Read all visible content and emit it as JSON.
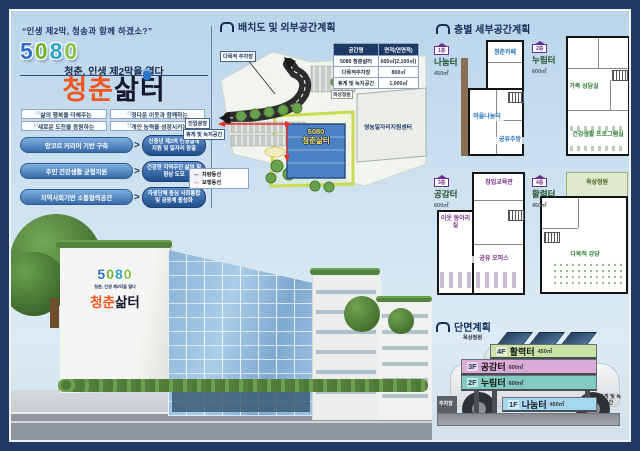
{
  "header": {
    "quote": "“인생 제2막, 청송과 함께 하겠소?”",
    "logo_letters": [
      "5",
      "0",
      "8",
      "0"
    ],
    "subtitle": "청춘, 인생 제2막을 열다",
    "title_orange": "청춘",
    "title_dark": "삶터",
    "value_boxes": [
      "삶의 행복을 더해주는",
      "정다운 이웃과 함께하는",
      "새로운 도전을 응원하는",
      "개인 능력을 성장시키는"
    ],
    "strategies": [
      {
        "goal": "앙코르 커리어 기반 구축",
        "outcome": "신중년 제2의 인생설계 지원 및 일자리 창출"
      },
      {
        "goal": "주민 건강생활 균형지원",
        "outcome": "건강한 지역주민 삶의 질 향상 도모"
      },
      {
        "goal": "지역사회기반 소통협력공간",
        "outcome": "자생단체 중심 사회통합 및 공동체 활성화"
      }
    ]
  },
  "site_plan": {
    "title": "배치도 및 외부공간계획",
    "table": {
      "headers": [
        "공간명",
        "면적(연면적)"
      ],
      "rows": [
        [
          "5080 청춘삶터",
          "600㎡(2,100㎡)"
        ],
        [
          "다목적주차장",
          "800㎡"
        ],
        [
          "휴게 및 녹지공간",
          "1,000㎡"
        ]
      ]
    },
    "labels": {
      "parking": "다목적 주차장",
      "plaza": "진입광장",
      "green": "휴게 및 녹지공간",
      "support_center": "영농일자리지원센터",
      "garden": "목성정원",
      "building_line1": "5080",
      "building_line2": "청춘삶터"
    },
    "legend": [
      {
        "label": "차량동선",
        "color": "#1a1a1a"
      },
      {
        "label": "보행동선",
        "color": "#e03131"
      }
    ]
  },
  "floor_plans": {
    "title": "층별 세부공간계획",
    "plans": [
      {
        "floor": "1층",
        "name": "나눔터",
        "area": "450㎡",
        "rooms": [
          "청춘카페",
          "마을나눔터",
          "공유주방"
        ]
      },
      {
        "floor": "2층",
        "name": "누림터",
        "area": "600㎡",
        "rooms": [
          "가족 상담실",
          "건강생활 프로그램실"
        ]
      },
      {
        "floor": "3층",
        "name": "공감터",
        "area": "600㎡",
        "rooms": [
          "창업교육관",
          "이웃 동아리실",
          "공유 오피스"
        ]
      },
      {
        "floor": "4층",
        "name": "활력터",
        "area": "450㎡",
        "rooms": [
          "옥상정원",
          "다목적 강당"
        ]
      }
    ]
  },
  "section_plan": {
    "title": "단면계획",
    "floors": [
      {
        "level": "4F",
        "name": "활력터",
        "area": "450㎡",
        "color": "#c9e3a6"
      },
      {
        "level": "3F",
        "name": "공감터",
        "area": "600㎡",
        "color": "#d9abd6"
      },
      {
        "level": "2F",
        "name": "누림터",
        "area": "600㎡",
        "color": "#82cbc2"
      },
      {
        "level": "1F",
        "name": "나눔터",
        "area": "450㎡",
        "color": "#a6d7f0"
      }
    ],
    "labels": {
      "roof_garden": "옥상정원",
      "rest_green": "휴게 및 녹지공간",
      "parking": "주차장"
    }
  },
  "building_sign": {
    "sub": "청춘, 인생 제2막을 열다",
    "name_orange": "청춘",
    "name_dark": "삶터"
  }
}
